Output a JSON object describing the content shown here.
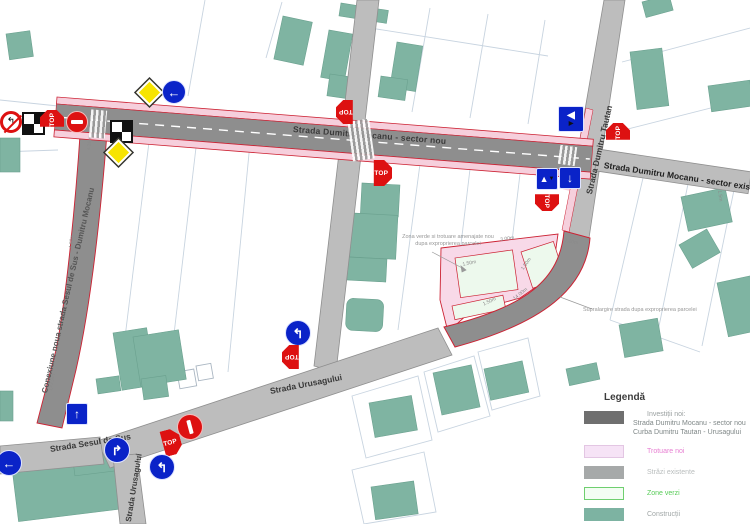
{
  "streets": {
    "mocanu_nou": "Strada Dumitru Mocanu - sector nou",
    "mocanu_exist": "Strada Dumitru Mocanu - sector exist",
    "tautan": "Strada Dumitru Tautan",
    "conexiune": "Conexiune noua strada Sesul de Sus - Dumitru Mocanu",
    "urusagului": "Strada Urusagului",
    "sesul_de_sus": "Strada Sesul de Sus",
    "urusagului_sud": "Strada Urusagului"
  },
  "annotations": {
    "zona_verde_line1": "Zona verde si trotuare amenajate nou",
    "zona_verde_line2": "dupa exproprierea parcelei",
    "supralargire": "Supralargire strada dupa exproprierea parcelei",
    "dims": [
      "4.38m",
      "4.50m",
      "L=2.9m",
      "7.00m",
      "14.00m",
      "3.00m",
      "1.50m",
      "1.50m",
      "1.50m",
      "1.5m"
    ]
  },
  "signs": {
    "stop": "STOP"
  },
  "icons": {
    "left_arrow": "←",
    "up_arrow": "↑",
    "down_arrow": "↓",
    "turn_left": "↰",
    "turn_right": "↱",
    "no_left_turn": "↰",
    "priority_big": "◀",
    "priority_small": "▶",
    "priority_up": "▲",
    "priority_down": "▼"
  },
  "legend": {
    "title": "Legendă",
    "items": [
      {
        "label": "Investiții noi:",
        "line2": "Strada Dumitru Mocanu - sector nou",
        "line3": "Curba Dumitru Tautan - Urusagului",
        "color": "#6f6f6f"
      },
      {
        "label": "Trotuare noi",
        "color": "#f6e3f6"
      },
      {
        "label": "Străzi existente",
        "color": "#a6a9a9"
      },
      {
        "label": "Zone verzi",
        "color": "#f3fdf3"
      },
      {
        "label": "Construcții",
        "color": "#7db3a2"
      }
    ]
  },
  "colors": {
    "new_road": "#8e8e8e",
    "existing_road": "#bdbdbd",
    "new_sidewalk": "#f6cfdc",
    "red_outline": "#cc2233",
    "building": "#7fb4a2",
    "green_zone": "#edf9ed",
    "sign_blue": "#0a23c8",
    "sign_red": "#dd1111"
  }
}
